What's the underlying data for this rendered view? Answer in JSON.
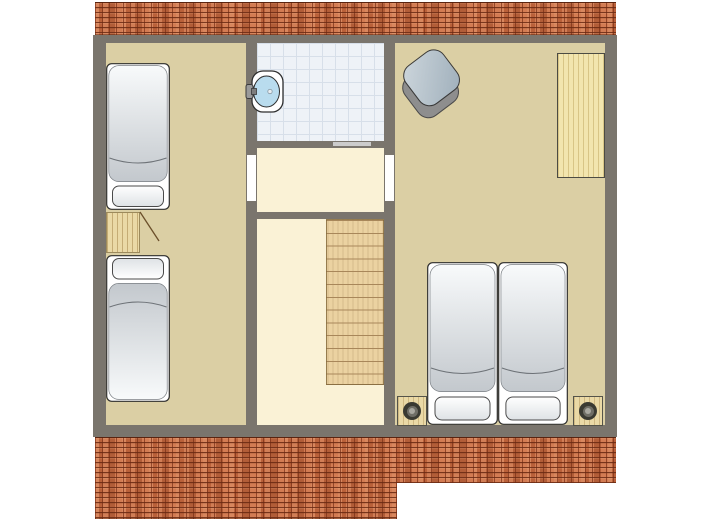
{
  "scene": {
    "kind": "architectural-floor-plan",
    "view": "top-down",
    "visible_text": []
  },
  "palette": {
    "wall": "#7a756d",
    "floor-tan": "#dbcfa4",
    "floor-cream": "#faf2d6",
    "tile": "#eef2f7",
    "tile-grid": "#d7dfe9",
    "wood": "#ead9a6",
    "desk-wood": "#f2e5ae",
    "stair-wood": "#ebd2a1",
    "stair-line": "#a8875a",
    "brick": "#c96e44",
    "door-slide": "#cccccc",
    "basin": "#b9dcee",
    "bed-base": "#ffffff",
    "mattress-light": "#f8fafb",
    "mattress-dark": "#c3c8cd",
    "pillow-light": "#ffffff",
    "pillow-dark": "#dee2e5",
    "chair-side": "#8e8e8e",
    "chair-top": "#bfcad3",
    "speaker-dark": "#3a3a32",
    "speaker-mid": "#6f6e66",
    "speaker-light": "#a9a8a0",
    "outline": "#2e2e2e"
  },
  "plan": {
    "roof_brick_strips": [
      {
        "id": "top-strip"
      },
      {
        "id": "bottom-strip",
        "note": "left portion steps down lower than right portion"
      }
    ],
    "rooms": [
      {
        "id": "bedroom-left",
        "floor": "tan",
        "furniture": [
          {
            "id": "single-bed-upper",
            "pillow_end": "south"
          },
          {
            "id": "bedside-cabinet",
            "detail": "open-door-swing-line"
          },
          {
            "id": "single-bed-lower",
            "pillow_end": "north"
          }
        ]
      },
      {
        "id": "bathroom",
        "floor": "white-tile-grid",
        "furniture": [
          {
            "id": "wash-basin",
            "detail": "oval-basin-with-tap-and-drain"
          }
        ],
        "doors": [
          {
            "id": "sliding-door",
            "side": "south-east"
          }
        ]
      },
      {
        "id": "landing",
        "floor": "cream",
        "doors": [
          {
            "id": "door-to-bedroom-left"
          },
          {
            "id": "door-to-bedroom-right"
          }
        ]
      },
      {
        "id": "stair-hall",
        "floor": "cream",
        "furniture": [
          {
            "id": "staircase",
            "steps": 13,
            "position": "east-side"
          }
        ]
      },
      {
        "id": "bedroom-right",
        "floor": "tan",
        "furniture": [
          {
            "id": "armchair",
            "detail": "rotated-square-pouf"
          },
          {
            "id": "desk",
            "detail": "wood, along east wall"
          },
          {
            "id": "twin-bed-left",
            "pillow_end": "south"
          },
          {
            "id": "twin-bed-right",
            "pillow_end": "south"
          },
          {
            "id": "speaker-box-west"
          },
          {
            "id": "speaker-box-east"
          }
        ]
      }
    ]
  }
}
